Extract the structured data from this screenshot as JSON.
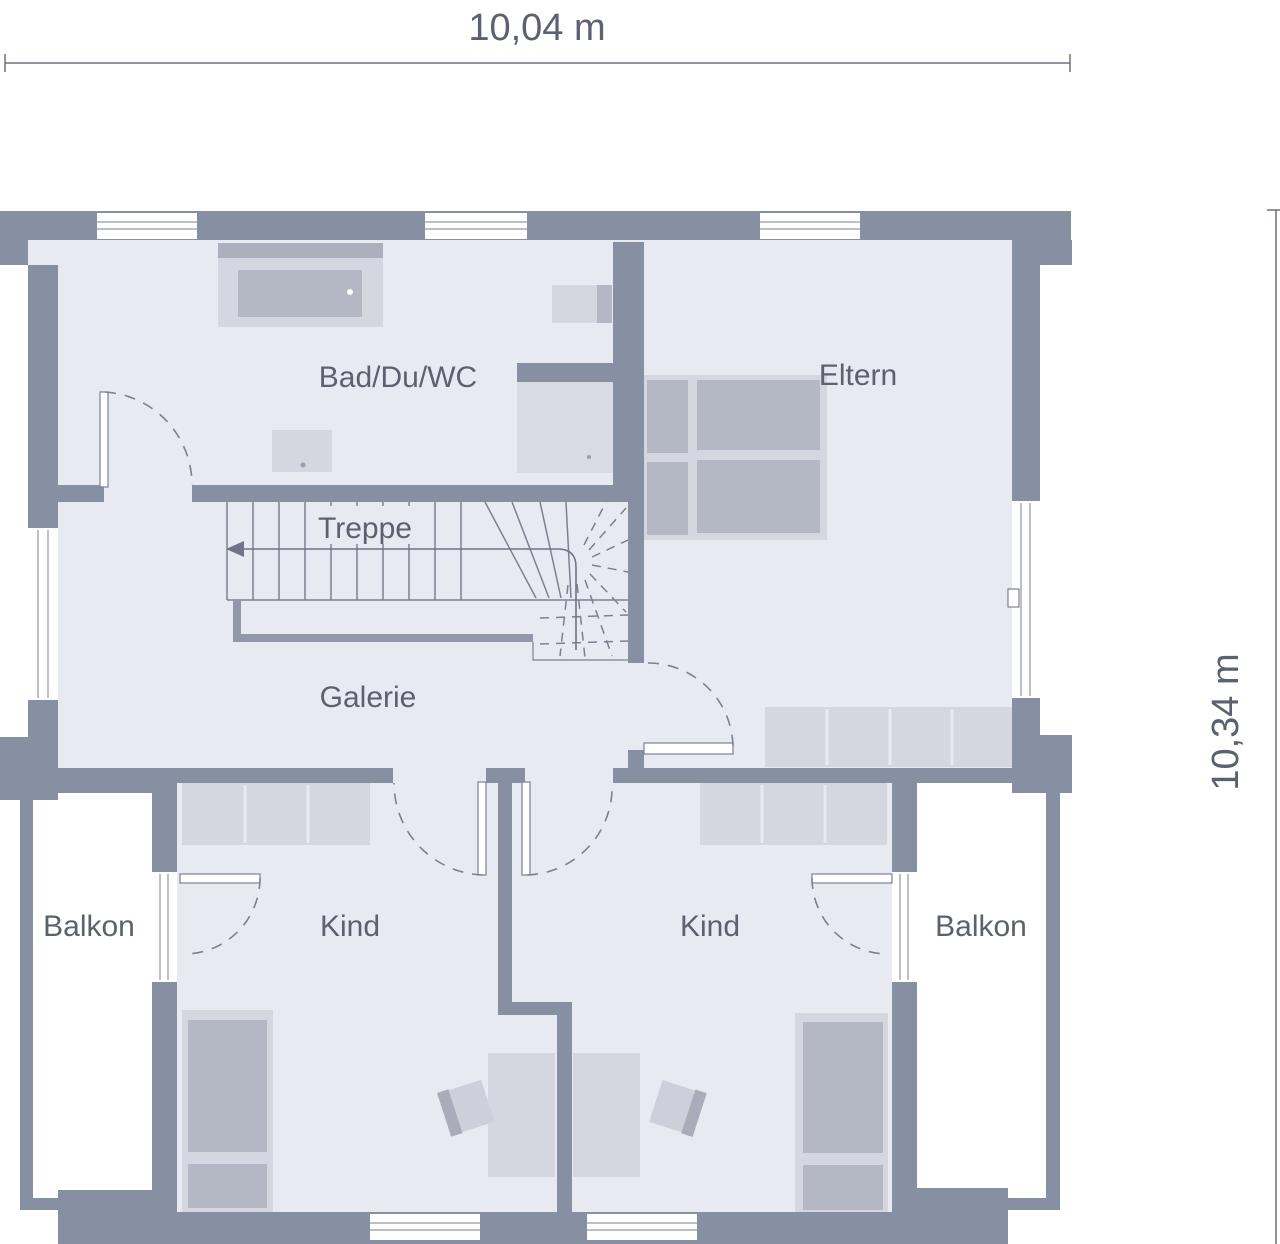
{
  "dimensions": {
    "width_label": "10,04 m",
    "height_label": "10,34 m"
  },
  "rooms": {
    "bath": "Bad/Du/WC",
    "parents": "Eltern",
    "stairs": "Treppe",
    "gallery": "Galerie",
    "child_left": "Kind",
    "child_right": "Kind",
    "balcony_left": "Balkon",
    "balcony_right": "Balkon"
  },
  "colors": {
    "wall": "#878fa2",
    "floor": "#e8eaf1",
    "furniture-light": "#d4d7e0",
    "furniture-dark": "#b4b8c5",
    "furniture-deck": "#acb0be",
    "shower": "#d9dbe2",
    "line": "#7b8193",
    "text": "#5c616f",
    "outside": "#ffffff"
  }
}
